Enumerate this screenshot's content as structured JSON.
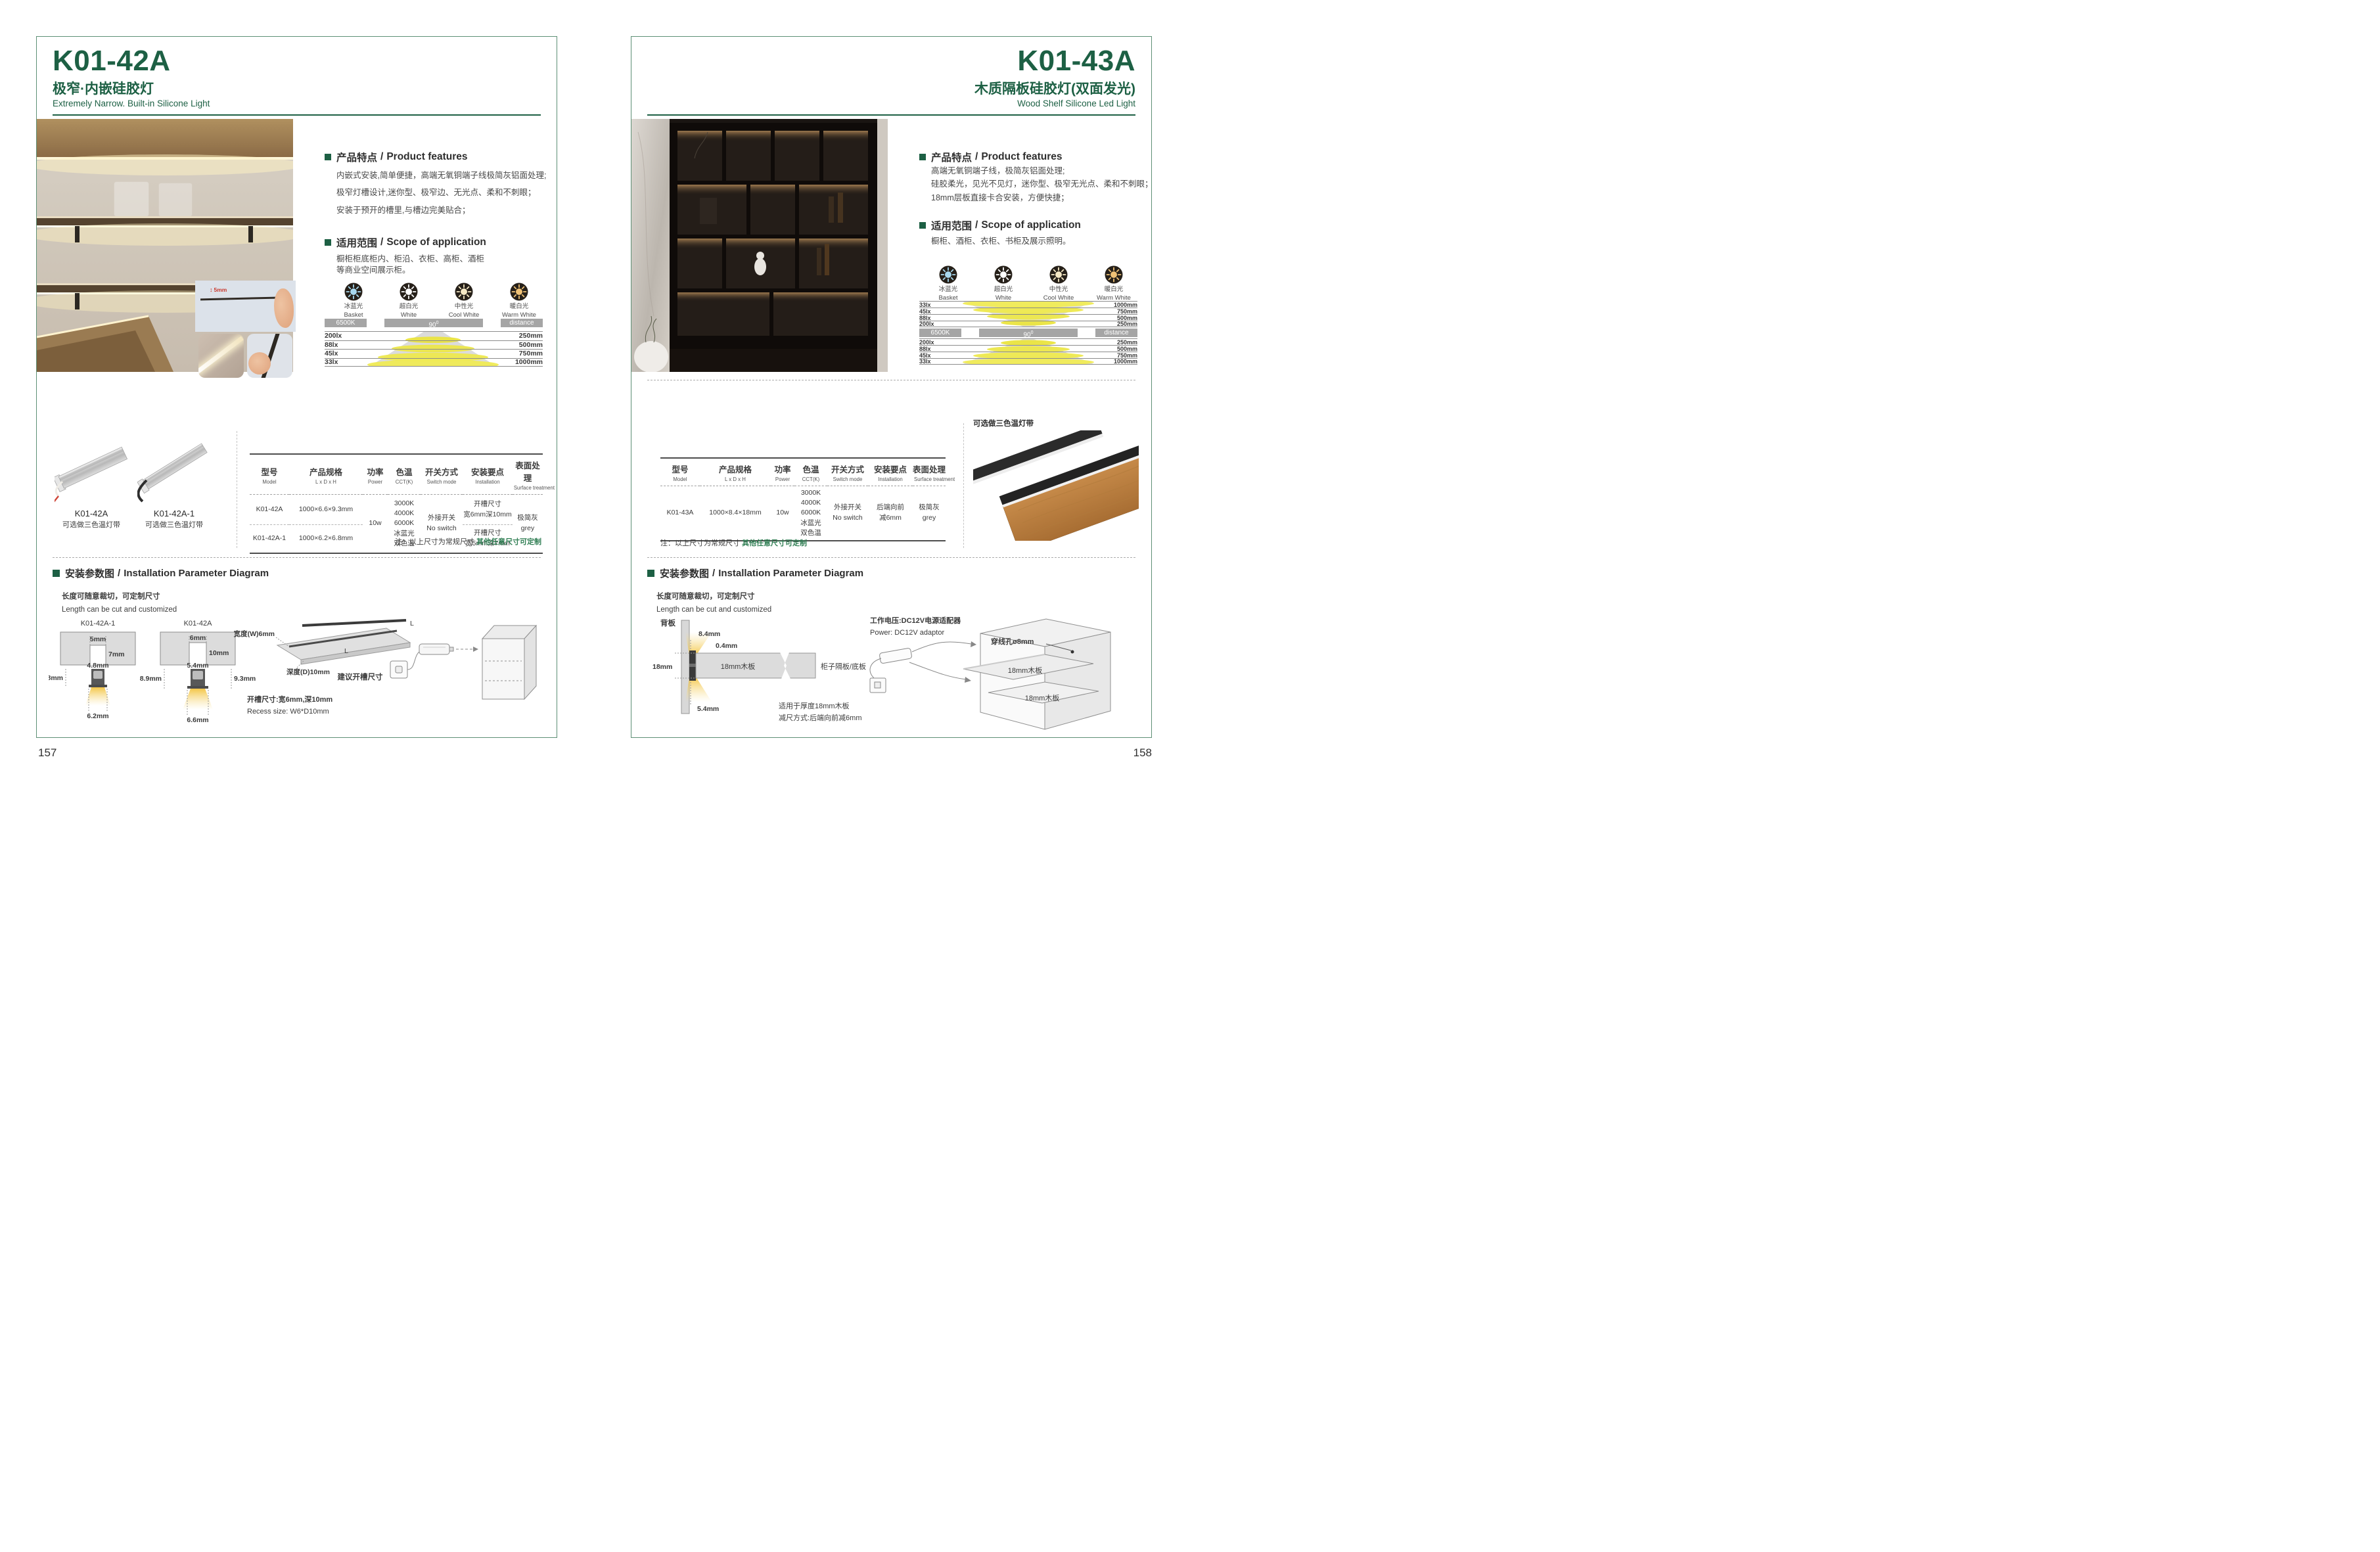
{
  "sep": "/",
  "left": {
    "page_number": "157",
    "model": "K01-42A",
    "title_zh": "极窄·内嵌硅胶灯",
    "title_en": "Extremely Narrow. Built-in Silicone Light",
    "photo": {
      "dim": "5mm"
    },
    "features": {
      "title_zh": "产品特点",
      "title_en": "Product features",
      "lines": [
        "内嵌式安装,简单便捷，高端无氧铜端子线极简灰铝面处理;",
        "极窄灯槽设计,迷你型、极窄边、无光点、柔和不刺眼；",
        "安装于预开的槽里,与槽边完美贴合；"
      ]
    },
    "scope": {
      "title_zh": "适用范围",
      "title_en": "Scope of application",
      "lines": [
        "橱柜柜底柜内、柜沿、衣柜、高柜、酒柜",
        "等商业空间展示柜。"
      ]
    },
    "light_colors": [
      {
        "zh": "冰蓝光",
        "en": "Basket",
        "color": "#a8d8ee"
      },
      {
        "zh": "超白光",
        "en": "White",
        "color": "#ffffff"
      },
      {
        "zh": "中性光",
        "en": "Cool White",
        "color": "#f6e9c5"
      },
      {
        "zh": "暖白光",
        "en": "Warm White",
        "color": "#f0c276"
      }
    ],
    "lux": {
      "cct": "6500K",
      "angle": "90",
      "angle_sup": "0",
      "distance": "distance",
      "rows": [
        {
          "lux": "200lx",
          "dist": "250mm"
        },
        {
          "lux": "88lx",
          "dist": "500mm"
        },
        {
          "lux": "45lx",
          "dist": "750mm"
        },
        {
          "lux": "33lx",
          "dist": "1000mm"
        }
      ]
    },
    "products": [
      {
        "name": "K01-42A",
        "note": "可选做三色温灯带"
      },
      {
        "name": "K01-42A-1",
        "note": "可选做三色温灯带"
      }
    ],
    "spec": {
      "headers": [
        {
          "zh": "型号",
          "en": "Model"
        },
        {
          "zh": "产品规格",
          "en": "L x D x H"
        },
        {
          "zh": "功率",
          "en": "Power"
        },
        {
          "zh": "色温",
          "en": "CCT(K)"
        },
        {
          "zh": "开关方式",
          "en": "Switch mode"
        },
        {
          "zh": "安装要点",
          "en": "Installation"
        },
        {
          "zh": "表面处理",
          "en": "Surface treatment"
        }
      ],
      "rows": [
        {
          "model": "K01-42A",
          "size": "1000×6.6×9.3mm",
          "install_a": "开槽尺寸",
          "install_b": "宽6mm深10mm"
        },
        {
          "model": "K01-42A-1",
          "size": "1000×6.2×6.8mm",
          "install_a": "开槽尺寸",
          "install_b": "宽5mm深7mm"
        }
      ],
      "power": "10w",
      "cct": [
        "3000K",
        "4000K",
        "6000K",
        "冰蓝光",
        "双色温"
      ],
      "switch_a": "外接开关",
      "switch_b": "No switch",
      "surface_a": "极简灰",
      "surface_b": "grey"
    },
    "note": {
      "prefix": "注：以上尺寸为常规尺寸 ",
      "highlight": "其他任意尺寸可定制"
    },
    "install": {
      "title_zh": "安装参数图",
      "title_en": "Installation Parameter Diagram",
      "cut_zh": "长度可随意裁切，可定制尺寸",
      "cut_en": "Length can be cut and customized",
      "d1": {
        "title": "K01-42A-1",
        "slot_w": "5mm",
        "slot_d": "7mm",
        "lamp_w": "4.8mm",
        "lamp_h": "6.8mm",
        "bottom": "6.2mm"
      },
      "d2": {
        "title": "K01-42A",
        "slot_w": "6mm",
        "slot_d": "10mm",
        "lamp_w": "5.4mm",
        "lamp_h": "8.9mm",
        "lamp_h2": "9.3mm",
        "bottom": "6.6mm"
      },
      "board": {
        "width": "宽度(W)6mm",
        "depth": "深度(D)10mm",
        "len_top": "L",
        "len_mid": "L",
        "caption": "建议开槽尺寸"
      },
      "recess_zh": "开槽尺寸:宽6mm,深10mm",
      "recess_en": "Recess size: W6*D10mm"
    }
  },
  "right": {
    "page_number": "158",
    "model": "K01-43A",
    "title_zh": "木质隔板硅胶灯(双面发光)",
    "title_en": "Wood Shelf Silicone Led Light",
    "features": {
      "title_zh": "产品特点",
      "title_en": "Product features",
      "lines": [
        "高端无氧铜端子线，极简灰铝面处理;",
        "硅胶柔光，见光不见灯，迷你型、极窄无光点、柔和不刺眼；",
        "18mm层板直接卡合安装，方便快捷；"
      ]
    },
    "scope": {
      "title_zh": "适用范围",
      "title_en": "Scope of application",
      "lines": [
        "橱柜、酒柜、衣柜、书柜及展示照明。"
      ]
    },
    "light_colors": [
      {
        "zh": "冰蓝光",
        "en": "Basket",
        "color": "#a8d8ee"
      },
      {
        "zh": "超白光",
        "en": "White",
        "color": "#ffffff"
      },
      {
        "zh": "中性光",
        "en": "Cool White",
        "color": "#f6e9c5"
      },
      {
        "zh": "暖白光",
        "en": "Warm White",
        "color": "#f0c276"
      }
    ],
    "lux": {
      "cct": "6500K",
      "angle": "90",
      "angle_sup": "0",
      "distance": "distance",
      "rows_top": [
        {
          "lux": "33lx",
          "dist": "1000mm"
        },
        {
          "lux": "45lx",
          "dist": "750mm"
        },
        {
          "lux": "88lx",
          "dist": "500mm"
        },
        {
          "lux": "200lx",
          "dist": "250mm"
        }
      ],
      "rows_bottom": [
        {
          "lux": "200lx",
          "dist": "250mm"
        },
        {
          "lux": "88lx",
          "dist": "500mm"
        },
        {
          "lux": "45lx",
          "dist": "750mm"
        },
        {
          "lux": "33lx",
          "dist": "1000mm"
        }
      ]
    },
    "product_note": "可选做三色温灯带",
    "spec": {
      "headers": [
        {
          "zh": "型号",
          "en": "Model"
        },
        {
          "zh": "产品规格",
          "en": "L x D x H"
        },
        {
          "zh": "功率",
          "en": "Power"
        },
        {
          "zh": "色温",
          "en": "CCT(K)"
        },
        {
          "zh": "开关方式",
          "en": "Switch mode"
        },
        {
          "zh": "安装要点",
          "en": "Installation"
        },
        {
          "zh": "表面处理",
          "en": "Surface treatment"
        }
      ],
      "row": {
        "model": "K01-43A",
        "size": "1000×8.4×18mm",
        "power": "10w",
        "cct": [
          "3000K",
          "4000K",
          "6000K",
          "冰蓝光",
          "双色温"
        ],
        "switch_a": "外接开关",
        "switch_b": "No switch",
        "install_a": "后端向前",
        "install_b": "减6mm",
        "surface_a": "极简灰",
        "surface_b": "grey"
      }
    },
    "note": {
      "prefix": "注：以上尺寸为常规尺寸 ",
      "highlight": "其他任意尺寸可定制"
    },
    "install": {
      "title_zh": "安装参数图",
      "title_en": "Installation Parameter Diagram",
      "cut_zh": "长度可随意裁切，可定制尺寸",
      "cut_en": "Length can be cut and customized",
      "diagram": {
        "back": "背板",
        "top": "8.4mm",
        "gap": "0.4mm",
        "thick": "18mm",
        "board": "18mm木板",
        "shelf": "柜子隔板/底板",
        "bottom": "5.4mm",
        "note1": "适用于厚度18mm木板",
        "note2": "减尺方式:后端向前减6mm"
      },
      "power_zh": "工作电压:DC12V电源适配器",
      "power_en": "Power: DC12V adaptor",
      "hole": "穿线孔ø8mm",
      "shelf1": "18mm木板",
      "shelf2": "18mm木板"
    }
  }
}
